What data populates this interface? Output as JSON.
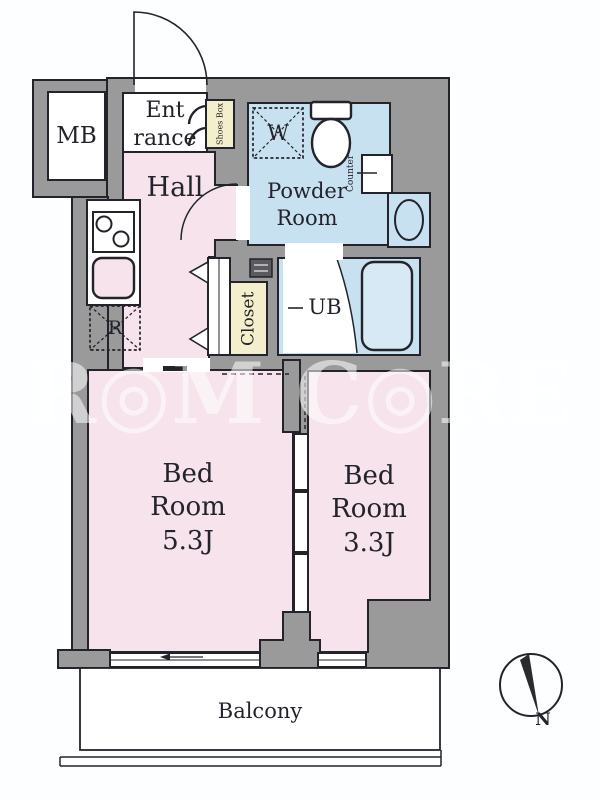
{
  "plan_title": "1R apartment floor plan",
  "labels": {
    "mb": "MB",
    "entrance_l1": "Ent",
    "entrance_l2": "rance",
    "shoes_box": "Shoes Box",
    "hall": "Hall",
    "powder_l1": "Powder",
    "powder_l2": "Room",
    "counter": "Counter",
    "washer": "W",
    "fridge": "R",
    "ub": "UB",
    "closet": "Closet",
    "bed1_l1": "Bed",
    "bed1_l2": "Room",
    "bed1_size": "5.3J",
    "bed2_l1": "Bed",
    "bed2_l2": "Room",
    "bed2_size": "3.3J",
    "balcony": "Balcony",
    "north": "N"
  },
  "watermark": "R◎M C◎RE",
  "colors": {
    "wall_gray": "#9a9a9a",
    "floor_pink": "#f6e3ec",
    "floor_blue": "#c8e1f0",
    "floor_cream": "#f3eecb",
    "tub_blue": "#d6e9f5",
    "outline": "#23232b",
    "watermark_white": "rgba(255,255,255,0.55)"
  }
}
